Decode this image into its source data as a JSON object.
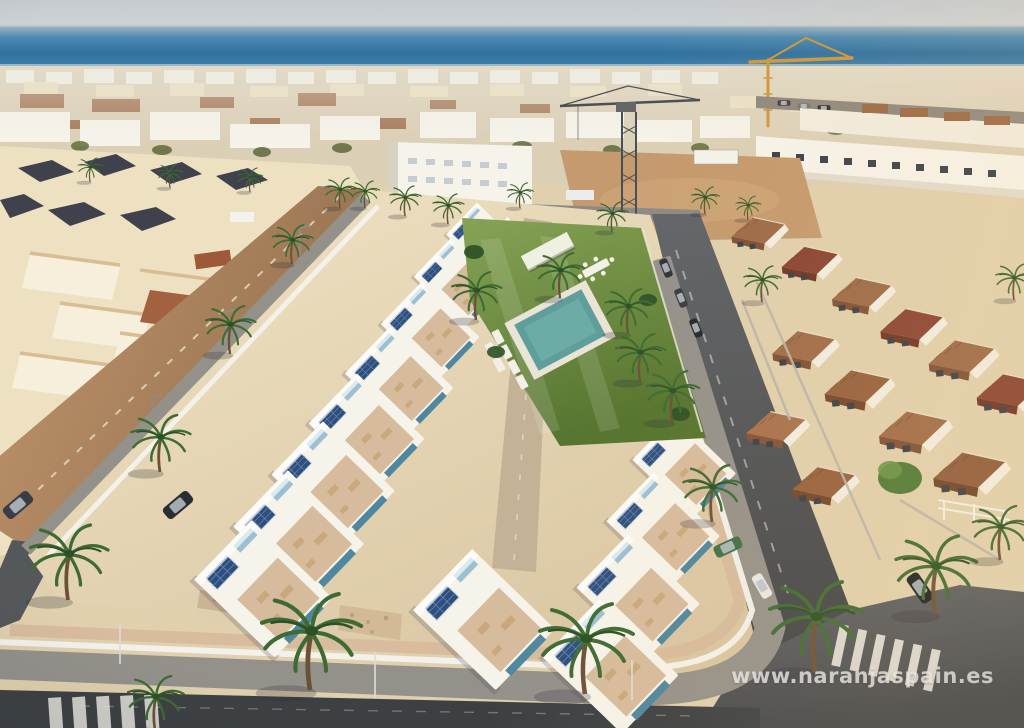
{
  "watermark": {
    "text": "www.naranjaspain.es"
  },
  "palette": {
    "sky": "#c7ccd1",
    "seaDeep": "#30719f",
    "sea": "#3d7ca9",
    "seaHaze": "#8fb0c0",
    "white": "#f6f3ea",
    "cream": "#eee1c2",
    "terracotta": "#9c6a48",
    "roofMaroon": "#8a4434",
    "darkRoof": "#3f414c",
    "sand": "#e0d0ae",
    "sandBright": "#efe3c4",
    "terrace": "#d6bb9d",
    "tanRoad": "#bb8f68",
    "asphalt": "#55585b",
    "asphaltDark": "#3c4043",
    "pavement": "#94918b",
    "wallWhite": "#f4f2ec",
    "lawn": "#7a9a4a",
    "lawnDark": "#4e6c2e",
    "pool": "#5f9e9a",
    "palm": "#3e6b33",
    "palmDark": "#2c5026",
    "trunk": "#6b5236",
    "solar": "#2e4f7d",
    "accentBlue": "#9cc0d2",
    "plunge": "#4f87a0",
    "craneYellow": "#d0973c",
    "craneGray": "#4a4f55",
    "marking": "#e9e6df",
    "court": "#a2613f",
    "watermark": "#e3e7ea"
  }
}
